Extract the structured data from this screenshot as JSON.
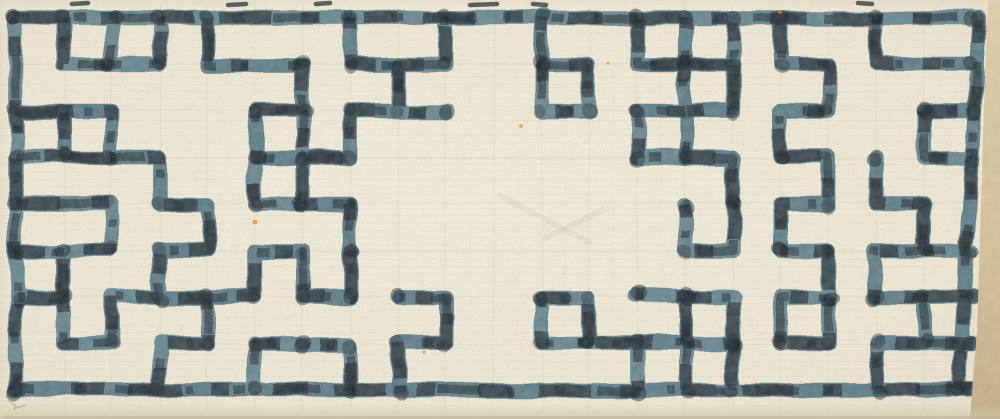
{
  "description": "Hand-drawn Chinese lattice (fretwork) window pattern; maze-like meander in mottled dark blue-grey ink on cream laid paper, dense at left and right with an open blank centre panel, faint pencil construction grid, tan paper edge strip at right.",
  "canvas": {
    "width": 1000,
    "height": 419
  },
  "palette": {
    "paper": "#f3eedd",
    "paper_edge": "#e9e0cb",
    "ink_blue": "#4e7280",
    "ink_blue_alt": "#5b7d88",
    "ink_dark": "#26323a",
    "ink_darkest": "#16212a",
    "pencil": "#b3a78c",
    "laid_line": "#cdc1a4",
    "edge_strip_top": "#dbcaa6",
    "edge_strip_bottom": "#c0aa7f",
    "shadow_band": "#bdb193"
  },
  "grid": {
    "origin_x": 16,
    "origin_y": 18,
    "cell_w": 47.8,
    "cell_h": 46.5,
    "cols": 20,
    "rows": 8
  },
  "stroke": {
    "blue_width": 14.5,
    "dark_width": 12,
    "mottle_width": 8.5,
    "dark_dash": "34 26 52 30 18 44",
    "mottle_dash": "12 30 44 26 8 40",
    "dark_opacity": 0.8,
    "mottle_opacity": 0.55
  },
  "pencil_grid": {
    "opacity": 0.2,
    "half_grid_opacity": 0.1,
    "laid_pitch": 7.3,
    "laid_opacity": 0.22
  },
  "lattice_paths": {
    "border": [
      [
        [
          0,
          0
        ],
        [
          20,
          0
        ]
      ],
      [
        [
          0,
          8
        ],
        [
          20,
          8
        ]
      ],
      [
        [
          0,
          0
        ],
        [
          0,
          8
        ]
      ],
      [
        [
          20.15,
          0
        ],
        [
          19.7,
          8
        ]
      ]
    ],
    "left_block": [
      [
        [
          1,
          0
        ],
        [
          1,
          1
        ],
        [
          3,
          1
        ],
        [
          3,
          0
        ]
      ],
      [
        [
          2,
          0
        ],
        [
          2,
          1
        ]
      ],
      [
        [
          0,
          2
        ],
        [
          2,
          2
        ],
        [
          2,
          3
        ],
        [
          1,
          3
        ],
        [
          1,
          2
        ]
      ],
      [
        [
          0,
          3
        ],
        [
          1,
          3
        ]
      ],
      [
        [
          4,
          0
        ],
        [
          4,
          1
        ],
        [
          6,
          1
        ],
        [
          6,
          2
        ],
        [
          5,
          2
        ],
        [
          5,
          3
        ],
        [
          7,
          3
        ],
        [
          7,
          2
        ],
        [
          8,
          2
        ],
        [
          8,
          1
        ],
        [
          7,
          1
        ],
        [
          7,
          0
        ]
      ],
      [
        [
          6,
          2
        ],
        [
          6,
          3
        ]
      ],
      [
        [
          6,
          3
        ],
        [
          6,
          4
        ],
        [
          7,
          4
        ],
        [
          7,
          5
        ]
      ],
      [
        [
          5,
          3
        ],
        [
          5,
          4
        ],
        [
          6,
          4
        ]
      ],
      [
        [
          2,
          3
        ],
        [
          3,
          3
        ],
        [
          3,
          4
        ],
        [
          4,
          4
        ],
        [
          4,
          5
        ],
        [
          3,
          5
        ],
        [
          3,
          6
        ],
        [
          5,
          6
        ],
        [
          5,
          5
        ],
        [
          6,
          5
        ],
        [
          6,
          6
        ],
        [
          7,
          6
        ],
        [
          7,
          5
        ]
      ],
      [
        [
          0,
          4
        ],
        [
          2,
          4
        ],
        [
          2,
          5
        ],
        [
          1,
          5
        ],
        [
          1,
          6
        ]
      ],
      [
        [
          0,
          5
        ],
        [
          1,
          5
        ]
      ],
      [
        [
          0,
          6
        ],
        [
          1,
          6
        ],
        [
          1,
          7
        ],
        [
          2,
          7
        ],
        [
          2,
          6
        ],
        [
          3,
          6
        ]
      ],
      [
        [
          4,
          6
        ],
        [
          4,
          7
        ],
        [
          3,
          7
        ],
        [
          3,
          8
        ]
      ],
      [
        [
          5,
          8
        ],
        [
          5,
          7
        ],
        [
          6,
          7
        ]
      ],
      [
        [
          7,
          8
        ],
        [
          7,
          7
        ],
        [
          6,
          7
        ]
      ]
    ],
    "top_pendants": [
      [
        [
          9,
          0
        ],
        [
          9,
          1
        ],
        [
          8,
          1
        ],
        [
          8,
          2
        ],
        [
          9,
          2
        ]
      ],
      [
        [
          11,
          0
        ],
        [
          11,
          1
        ]
      ],
      [
        [
          11,
          1
        ],
        [
          12,
          1
        ],
        [
          12,
          2
        ],
        [
          11,
          2
        ],
        [
          11,
          1
        ]
      ],
      [
        [
          13,
          0
        ],
        [
          13,
          1
        ],
        [
          14,
          1
        ],
        [
          14,
          2
        ],
        [
          13,
          2
        ]
      ],
      [
        [
          13,
          2
        ],
        [
          13,
          3
        ],
        [
          14,
          3
        ]
      ]
    ],
    "bottom_pendants": [
      [
        [
          8,
          8
        ],
        [
          8,
          7
        ],
        [
          9,
          7
        ],
        [
          9,
          6
        ],
        [
          8,
          6
        ]
      ],
      [
        [
          11,
          6
        ],
        [
          12,
          6
        ],
        [
          12,
          7
        ],
        [
          11,
          7
        ],
        [
          11,
          6
        ]
      ],
      [
        [
          13,
          8
        ],
        [
          13,
          7
        ],
        [
          12,
          7
        ]
      ],
      [
        [
          13,
          7
        ],
        [
          14,
          7
        ]
      ],
      [
        [
          14,
          8
        ],
        [
          14,
          6
        ],
        [
          13,
          6
        ]
      ]
    ],
    "right_block": [
      [
        [
          14,
          0
        ],
        [
          14,
          1
        ],
        [
          15,
          1
        ],
        [
          15,
          0
        ]
      ],
      [
        [
          16,
          0
        ],
        [
          16,
          1
        ],
        [
          17,
          1
        ],
        [
          17,
          2
        ],
        [
          16,
          2
        ],
        [
          16,
          3
        ]
      ],
      [
        [
          18,
          0
        ],
        [
          18,
          1
        ],
        [
          20,
          1
        ]
      ],
      [
        [
          15,
          1
        ],
        [
          15,
          2
        ],
        [
          14,
          2
        ],
        [
          14,
          3
        ],
        [
          15,
          3
        ],
        [
          15,
          4
        ]
      ],
      [
        [
          19,
          2
        ],
        [
          19,
          3
        ],
        [
          20,
          3
        ]
      ],
      [
        [
          20,
          2
        ],
        [
          19,
          2
        ]
      ],
      [
        [
          16,
          3
        ],
        [
          17,
          3
        ],
        [
          17,
          4
        ],
        [
          16,
          4
        ],
        [
          16,
          5
        ]
      ],
      [
        [
          18,
          3
        ],
        [
          18,
          4
        ],
        [
          19,
          4
        ],
        [
          19,
          5
        ],
        [
          18,
          5
        ],
        [
          18,
          6
        ]
      ],
      [
        [
          19,
          5
        ],
        [
          20,
          5
        ]
      ],
      [
        [
          15,
          4
        ],
        [
          15,
          5
        ],
        [
          14,
          5
        ],
        [
          14,
          4
        ]
      ],
      [
        [
          16,
          5
        ],
        [
          17,
          5
        ],
        [
          17,
          6
        ],
        [
          16,
          6
        ],
        [
          16,
          7
        ]
      ],
      [
        [
          14,
          6
        ],
        [
          15,
          6
        ],
        [
          15,
          7
        ],
        [
          14,
          7
        ],
        [
          14,
          6
        ]
      ],
      [
        [
          18,
          6
        ],
        [
          19,
          6
        ],
        [
          19,
          7
        ],
        [
          18,
          7
        ],
        [
          18,
          8
        ]
      ],
      [
        [
          19,
          6
        ],
        [
          20,
          6
        ]
      ],
      [
        [
          17,
          6
        ],
        [
          17,
          7
        ],
        [
          16,
          7
        ]
      ],
      [
        [
          15,
          7
        ],
        [
          15,
          8
        ]
      ],
      [
        [
          20,
          7
        ],
        [
          19,
          7
        ]
      ]
    ]
  },
  "ink_marks_top_edge": [
    [
      72,
      4,
      88,
      3
    ],
    [
      228,
      5,
      246,
      4
    ],
    [
      316,
      4,
      330,
      3
    ],
    [
      470,
      5,
      497,
      4
    ],
    [
      533,
      4,
      546,
      5
    ],
    [
      858,
      3,
      872,
      4
    ]
  ],
  "specks": [
    {
      "x": 255,
      "y": 222,
      "r": 2.4,
      "color": "#dd8f33"
    },
    {
      "x": 521,
      "y": 126,
      "r": 1.8,
      "color": "#d79a3d"
    },
    {
      "x": 780,
      "y": 12,
      "r": 2.0,
      "color": "#cf8a33"
    },
    {
      "x": 424,
      "y": 352,
      "r": 1.6,
      "color": "#c2954d"
    },
    {
      "x": 608,
      "y": 63,
      "r": 1.5,
      "color": "#cfa04a"
    }
  ],
  "pencil_marks": {
    "corner_arrow": [
      [
        8,
        400
      ],
      [
        17,
        407
      ],
      [
        13,
        409
      ],
      [
        26,
        405
      ]
    ],
    "centre_scribbles": [
      [
        [
          500,
          196
        ],
        [
          589,
          242
        ]
      ],
      [
        [
          546,
          238
        ],
        [
          601,
          211
        ]
      ]
    ]
  },
  "edge_strip_points": "988,0 1000,0 1000,419 970,419 977,330 984,110"
}
